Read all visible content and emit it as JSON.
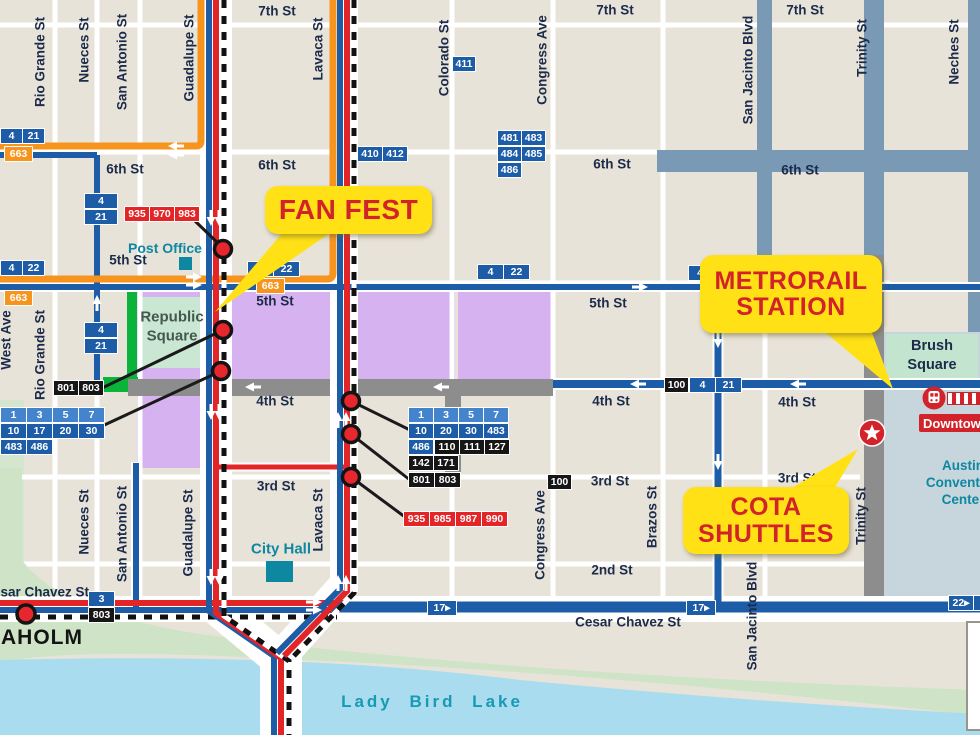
{
  "colors": {
    "background": "#e8e3d9",
    "route_blue": "#1d5ca6",
    "route_orange": "#f7941e",
    "route_red": "#e32528",
    "closed_street_gray": "#8d8d8d",
    "district_bluegray": "#7a99b5",
    "event_purple": "#d7b2f0",
    "park_green": "#c9e7d2",
    "highlight_green": "#0ab33a",
    "lake_blue": "#a9dcee",
    "shore_green": "#cfe4c6",
    "callout_yellow": "#ffe115",
    "callout_red_text": "#d2232a",
    "label_navy": "#1c2b4a",
    "poi_teal": "#0e87a0"
  },
  "callouts": {
    "fan_fest": "FAN FEST",
    "metrorail_line1": "METRORAIL",
    "metrorail_line2": "STATION",
    "cota_line1": "COTA",
    "cota_line2": "SHUTTLES"
  },
  "places": {
    "post_office": "Post Office",
    "republic_line1": "Republic",
    "republic_line2": "Square",
    "city_hall": "City Hall",
    "brush_line1": "Brush",
    "brush_line2": "Square",
    "convention_line1": "Austin",
    "convention_line2": "Convention",
    "convention_line3": "Center",
    "downtown": "Downtown",
    "lady_bird_lake": "Lady Bird Lake",
    "seaholm": "EAHOLM"
  },
  "street_labels": [
    {
      "t": "7th St",
      "x": 277,
      "y": 11
    },
    {
      "t": "7th St",
      "x": 615,
      "y": 10
    },
    {
      "t": "7th St",
      "x": 805,
      "y": 10
    },
    {
      "t": "6th St",
      "x": 125,
      "y": 169
    },
    {
      "t": "6th St",
      "x": 277,
      "y": 165
    },
    {
      "t": "6th St",
      "x": 612,
      "y": 164
    },
    {
      "t": "6th St",
      "x": 800,
      "y": 170
    },
    {
      "t": "5th St",
      "x": 128,
      "y": 260
    },
    {
      "t": "5th St",
      "x": 275,
      "y": 301
    },
    {
      "t": "5th St",
      "x": 608,
      "y": 303
    },
    {
      "t": "4th St",
      "x": 275,
      "y": 401
    },
    {
      "t": "4th St",
      "x": 611,
      "y": 401
    },
    {
      "t": "4th St",
      "x": 797,
      "y": 402
    },
    {
      "t": "3rd St",
      "x": 276,
      "y": 486
    },
    {
      "t": "3rd St",
      "x": 610,
      "y": 481
    },
    {
      "t": "3rd St",
      "x": 797,
      "y": 478
    },
    {
      "t": "2nd St",
      "x": 612,
      "y": 570
    },
    {
      "t": "esar Chavez St",
      "x": 41,
      "y": 592
    },
    {
      "t": "Cesar Chavez St",
      "x": 628,
      "y": 622
    },
    {
      "t": "Rio Grande St",
      "x": 40,
      "y": 62,
      "r": 1
    },
    {
      "t": "Rio Grande St",
      "x": 40,
      "y": 355,
      "r": 1
    },
    {
      "t": "West Ave",
      "x": 6,
      "y": 340,
      "r": 1
    },
    {
      "t": "Nueces St",
      "x": 84,
      "y": 50,
      "r": 1
    },
    {
      "t": "Nueces St",
      "x": 84,
      "y": 522,
      "r": 1
    },
    {
      "t": "San Antonio St",
      "x": 122,
      "y": 62,
      "r": 1
    },
    {
      "t": "San Antonio St",
      "x": 122,
      "y": 534,
      "r": 1
    },
    {
      "t": "Guadalupe St",
      "x": 189,
      "y": 58,
      "r": 1
    },
    {
      "t": "Guadalupe St",
      "x": 188,
      "y": 533,
      "r": 1
    },
    {
      "t": "Lavaca St",
      "x": 318,
      "y": 49,
      "r": 1
    },
    {
      "t": "Lavaca St",
      "x": 318,
      "y": 520,
      "r": 1
    },
    {
      "t": "Colorado St",
      "x": 444,
      "y": 58,
      "r": 1
    },
    {
      "t": "Congress Ave",
      "x": 542,
      "y": 60,
      "r": 1
    },
    {
      "t": "Congress Ave",
      "x": 540,
      "y": 535,
      "r": 1
    },
    {
      "t": "Brazos St",
      "x": 652,
      "y": 517,
      "r": 1
    },
    {
      "t": "San Jacinto Blvd",
      "x": 748,
      "y": 70,
      "r": 1
    },
    {
      "t": "San Jacinto Blvd",
      "x": 752,
      "y": 616,
      "r": 1
    },
    {
      "t": "Trinity St",
      "x": 862,
      "y": 48,
      "r": 1
    },
    {
      "t": "Trinity St",
      "x": 861,
      "y": 516,
      "r": 1
    },
    {
      "t": "Neches St",
      "x": 954,
      "y": 52,
      "r": 1
    }
  ],
  "route_badges": [
    {
      "cells": [
        "4",
        "21"
      ],
      "c": "blue",
      "x": 0,
      "y": 128,
      "w": 21
    },
    {
      "cells": [
        "663"
      ],
      "c": "orange",
      "x": 4,
      "y": 146,
      "w": 27
    },
    {
      "cells": [
        "4"
      ],
      "c": "blue",
      "x": 84,
      "y": 193,
      "w": 32
    },
    {
      "cells": [
        "21"
      ],
      "c": "blue",
      "x": 84,
      "y": 209,
      "w": 32
    },
    {
      "cells": [
        "935",
        "970",
        "983"
      ],
      "c": "red",
      "x": 124,
      "y": 206,
      "w": 24
    },
    {
      "cells": [
        "4",
        "22"
      ],
      "c": "blue",
      "x": 0,
      "y": 260,
      "w": 21
    },
    {
      "cells": [
        "663"
      ],
      "c": "orange",
      "x": 4,
      "y": 290,
      "w": 27
    },
    {
      "cells": [
        "4"
      ],
      "c": "blue",
      "x": 84,
      "y": 322,
      "w": 32
    },
    {
      "cells": [
        "21"
      ],
      "c": "blue",
      "x": 84,
      "y": 338,
      "w": 32
    },
    {
      "cells": [
        "801",
        "803"
      ],
      "c": "black",
      "x": 53,
      "y": 380,
      "w": 24
    },
    {
      "cells": [
        "1",
        "3",
        "5",
        "7"
      ],
      "c": "lightblue",
      "x": 0,
      "y": 407,
      "w": 25
    },
    {
      "cells": [
        "10",
        "17",
        "20",
        "30"
      ],
      "c": "blue",
      "x": 0,
      "y": 423,
      "w": 25
    },
    {
      "cells": [
        "483",
        "486"
      ],
      "c": "blue",
      "x": 0,
      "y": 439,
      "w": 25
    },
    {
      "cells": [
        "4",
        "22"
      ],
      "c": "blue",
      "x": 247,
      "y": 261,
      "w": 25
    },
    {
      "cells": [
        "663"
      ],
      "c": "orange",
      "x": 256,
      "y": 278,
      "w": 27
    },
    {
      "cells": [
        "411"
      ],
      "c": "blue",
      "x": 452,
      "y": 56,
      "w": 22
    },
    {
      "cells": [
        "410",
        "412"
      ],
      "c": "blue",
      "x": 357,
      "y": 146,
      "w": 24
    },
    {
      "cells": [
        "481",
        "483"
      ],
      "c": "blue",
      "x": 497,
      "y": 130,
      "w": 23
    },
    {
      "cells": [
        "484",
        "485"
      ],
      "c": "blue",
      "x": 497,
      "y": 146,
      "w": 23
    },
    {
      "cells": [
        "486"
      ],
      "c": "blue",
      "x": 497,
      "y": 162,
      "w": 23
    },
    {
      "cells": [
        "4",
        "22"
      ],
      "c": "blue",
      "x": 477,
      "y": 264,
      "w": 25
    },
    {
      "cells": [
        "4"
      ],
      "c": "blue",
      "x": 688,
      "y": 265,
      "w": 22
    },
    {
      "cells": [
        "100"
      ],
      "c": "black",
      "x": 664,
      "y": 377,
      "w": 23
    },
    {
      "cells": [
        "4",
        "21"
      ],
      "c": "blue",
      "x": 689,
      "y": 377,
      "w": 25
    },
    {
      "cells": [
        "100"
      ],
      "c": "black",
      "x": 547,
      "y": 474,
      "w": 23
    },
    {
      "cells": [
        "1",
        "3",
        "5",
        "7"
      ],
      "c": "lightblue",
      "x": 408,
      "y": 407,
      "w": 24
    },
    {
      "cells": [
        "10",
        "20",
        "30",
        "483"
      ],
      "c": "blue",
      "x": 408,
      "y": 423,
      "w": 24
    },
    {
      "cells": [
        "486"
      ],
      "c": "blue",
      "x": 408,
      "y": 439,
      "w": 24
    },
    {
      "cells": [
        "110",
        "111",
        "127"
      ],
      "c": "black",
      "x": 434,
      "y": 439,
      "w": 24
    },
    {
      "cells": [
        "142",
        "171"
      ],
      "c": "black",
      "x": 408,
      "y": 455,
      "w": 24
    },
    {
      "cells": [
        "801",
        "803"
      ],
      "c": "black",
      "x": 408,
      "y": 472,
      "w": 25
    },
    {
      "cells": [
        "935",
        "985",
        "987",
        "990"
      ],
      "c": "red",
      "x": 403,
      "y": 511,
      "w": 25
    },
    {
      "cells": [
        "3"
      ],
      "c": "blue",
      "x": 88,
      "y": 591,
      "w": 25
    },
    {
      "cells": [
        "803"
      ],
      "c": "black",
      "x": 88,
      "y": 607,
      "w": 25
    },
    {
      "cells": [
        "17▸"
      ],
      "c": "blue",
      "x": 427,
      "y": 600,
      "w": 28
    },
    {
      "cells": [
        "17▸"
      ],
      "c": "blue",
      "x": 686,
      "y": 600,
      "w": 28
    },
    {
      "cells": [
        "22▸",
        "1"
      ],
      "c": "blue",
      "x": 948,
      "y": 595,
      "w": 24
    }
  ]
}
